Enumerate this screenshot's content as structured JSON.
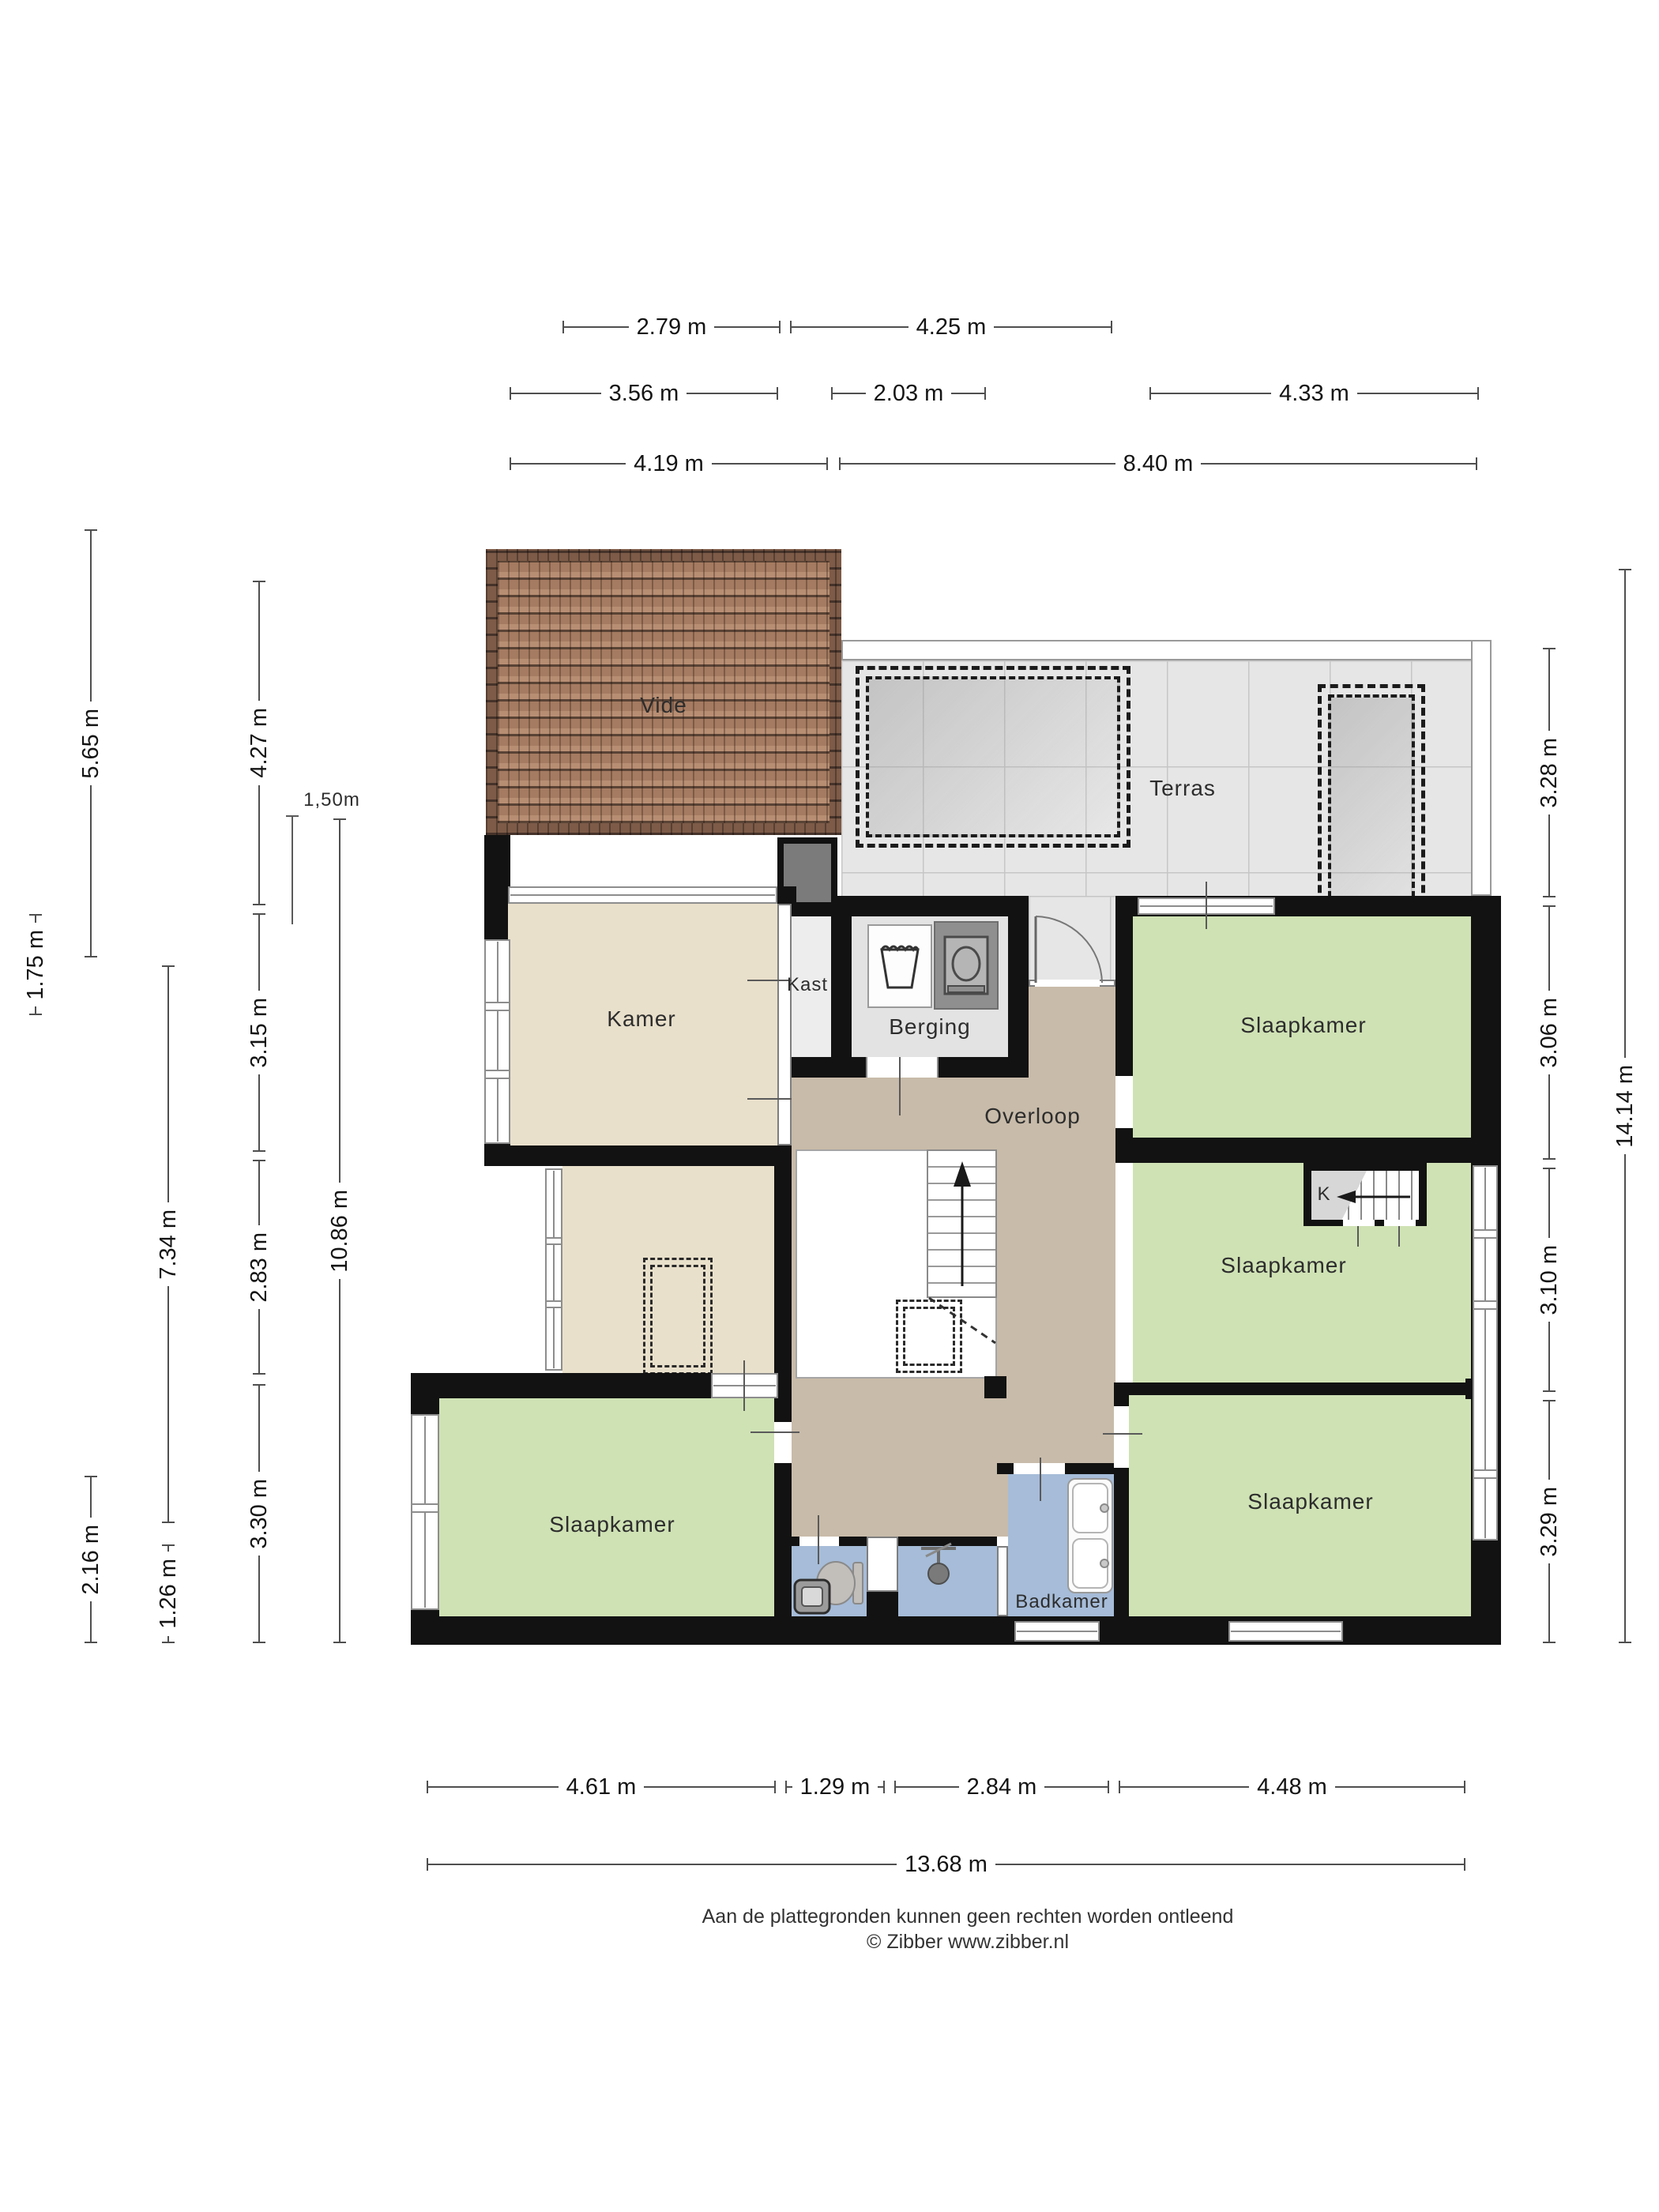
{
  "rooms": {
    "vide": "Vide",
    "terras": "Terras",
    "kamer": "Kamer",
    "kast": "Kast",
    "berging": "Berging",
    "overloop": "Overloop",
    "slaapkamer_top_right": "Slaapkamer",
    "slaapkamer_middle_right": "Slaapkamer",
    "slaapkamer_bottom_left": "Slaapkamer",
    "slaapkamer_bottom_right": "Slaapkamer",
    "badkamer": "Badkamer",
    "stair_closet": "K"
  },
  "dims": {
    "t1a": "2.79 m",
    "t1b": "4.25 m",
    "t2a": "3.56 m",
    "t2b": "2.03 m",
    "t2c": "4.33 m",
    "t3a": "4.19 m",
    "t3b": "8.40 m",
    "l_565": "5.65 m",
    "l_427": "4.27 m",
    "l_175": "1.75 m",
    "l_315": "3.15 m",
    "l_734": "7.34 m",
    "l_283": "2.83 m",
    "l_1086": "10.86 m",
    "l_330": "3.30 m",
    "l_216": "2.16 m",
    "l_126": "1.26 m",
    "r_328": "3.28 m",
    "r_306": "3.06 m",
    "r_1414": "14.14 m",
    "r_310": "3.10 m",
    "r_329": "3.29 m",
    "b_461": "4.61 m",
    "b_129": "1.29 m",
    "b_284": "2.84 m",
    "b_448": "4.48 m",
    "b_1368": "13.68 m",
    "height_marker": "1,50m"
  },
  "footer": {
    "line1": "Aan de plattegronden kunnen geen rechten worden ontleend",
    "line2": "© Zibber www.zibber.nl"
  },
  "colors": {
    "wall": "#121212",
    "bedroom_floor": "#cfe2b4",
    "hall_floor": "#c8bba9",
    "kamer_floor": "#e9e0cb",
    "bath_floor": "#a6bcd8",
    "storage_floor": "#e3e3e3",
    "closet_floor": "#ededed",
    "terrace_floor": "#e6e6e6",
    "duct_gray": "#7b7b7b"
  }
}
